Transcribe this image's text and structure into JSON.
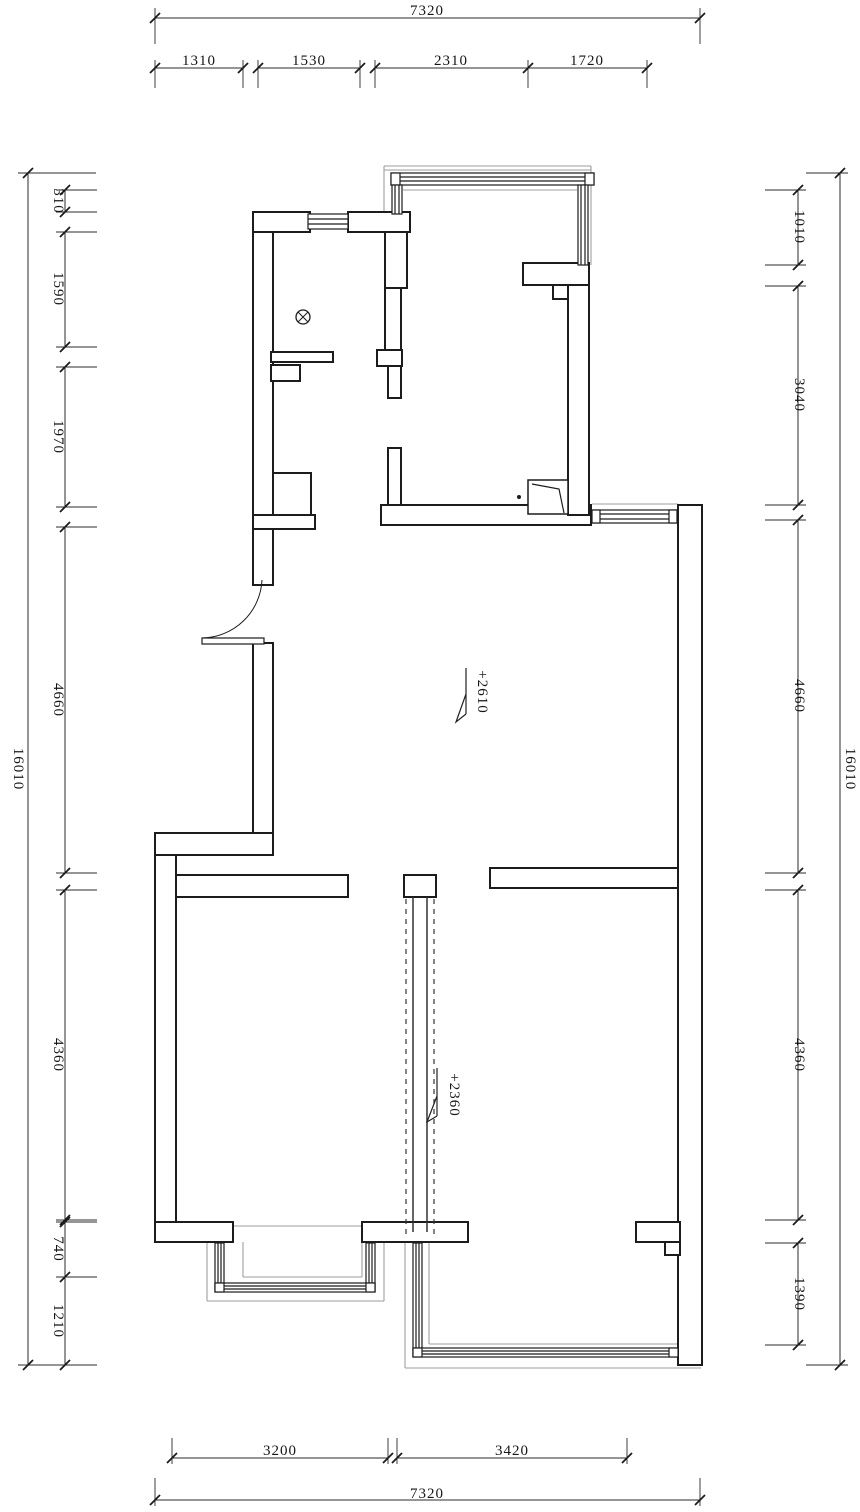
{
  "drawing": {
    "type": "floor-plan",
    "colors": {
      "line": "#1c1c1c",
      "dim": "#2b2b2b",
      "light": "#9e9e9e",
      "background": "#ffffff"
    }
  },
  "dims": {
    "top_overall": "7320",
    "top_segments": [
      "1310",
      "1530",
      "2310",
      "1720"
    ],
    "bottom_segments": [
      "3200",
      "3420"
    ],
    "bottom_overall": "7320",
    "left_overall": "16010",
    "left_segments": [
      "310",
      "1590",
      "1970",
      "4660",
      "4360",
      "740",
      "1210"
    ],
    "right_segments": [
      "1010",
      "3040",
      "4660",
      "4360",
      "1390"
    ],
    "right_overall": "16010"
  },
  "levels": {
    "living_level": "+2610",
    "passage_level": "+2360"
  }
}
